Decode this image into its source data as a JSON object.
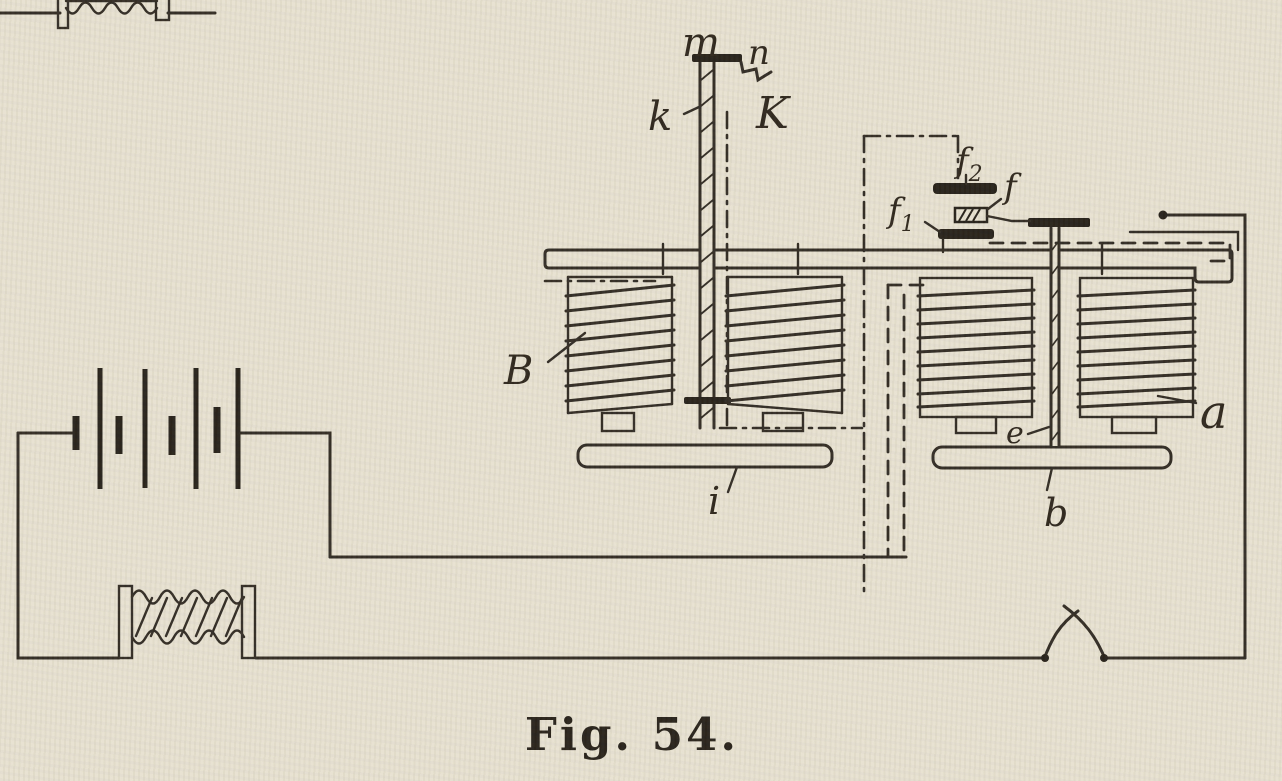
{
  "figure": {
    "caption": "Fig. 54."
  },
  "labels": {
    "m": "m",
    "n": "n",
    "K": "K",
    "k": "k",
    "f_letter": "f",
    "f1_sub": "1",
    "f2_sub": "2",
    "coil_left": "B",
    "coil_right": "a",
    "rod_right": "e",
    "bar_left": "i",
    "bar_right": "b"
  },
  "colors": {
    "paper": "#e7e1d0",
    "ink": "#2e2820",
    "ink_heavy": "#231d15"
  }
}
